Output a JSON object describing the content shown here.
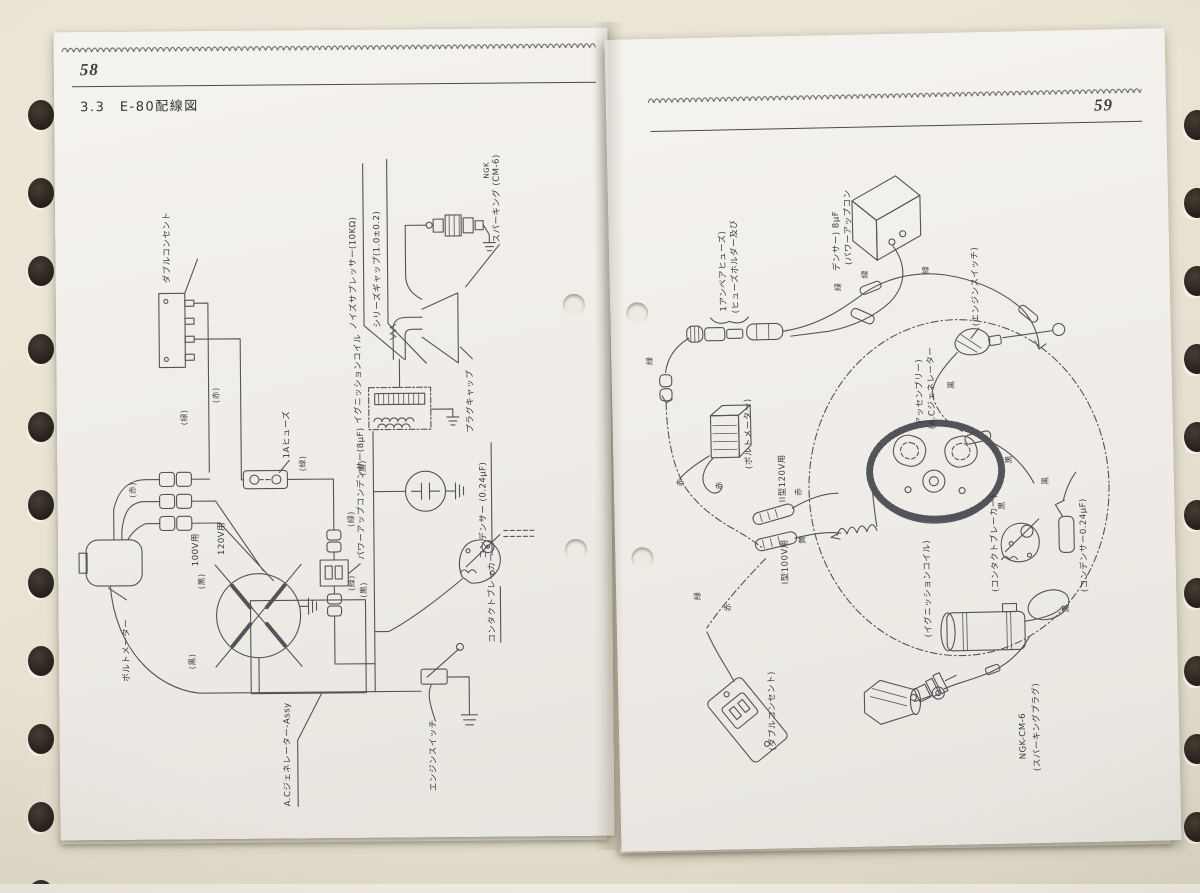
{
  "left_page": {
    "page_number": "58",
    "section_title": "3.3　E-80配線図",
    "labels": {
      "double_outlet": "ダブルコンセント",
      "noise_suppressor": "ノイズサプレッサー(10KΩ)",
      "series_gap": "シリーズギャップ(1.0±0.2)",
      "ngk": "NGK",
      "sparking": "スパーキング (CM-6)",
      "plug_cap": "プラグキャップ",
      "ignition_coil": "イグニッションコイル",
      "condenser": "コンデンサー (0.24μF)",
      "contact_breaker": "コンタクトブレーカー",
      "power_up_condenser": "パワーアップコンデンサー(8μF)",
      "fuse_1a": "1Aヒューズ",
      "for_100v": "100V用",
      "for_120v": "120V用",
      "volt_meter": "ボルトメーター",
      "ac_generator": "A.Cジェネレーター-Assy",
      "engine_switch": "エンジンスイッチ",
      "wire_red": "(赤)",
      "wire_green": "(緑)",
      "wire_black": "(黒)"
    }
  },
  "right_page": {
    "page_number": "59",
    "labels": {
      "power_up_condenser_1": "(パワーアップコン",
      "power_up_condenser_2": "デンサー) 8μF",
      "fuse_holder_1": "(ヒューズホルダー及び",
      "fuse_holder_2": "1アンペアヒューズ)",
      "volt_meter": "(ボルトメーター)",
      "type2_120v": "II型120V用",
      "type1_100v": "I型100V用",
      "double_outlet": "(ダブルコンセント)",
      "ac_generator_1": "(A.Cジェネレーター",
      "ac_generator_2": "アッセンブリー)",
      "engine_switch": "(エンジンスイッチ)",
      "contact_breaker": "(コンタクトブレーカー)",
      "condenser": "(コンデンサー0.24μF)",
      "ignition_coil": "(イグニッションコイル)",
      "sparking_plug_1": "(スパーキングプラグ)",
      "sparking_plug_2": "NGK-CM-6",
      "wire_red": "赤",
      "wire_green": "緑",
      "wire_black": "黒",
      "wire_yellow": "黄"
    }
  }
}
